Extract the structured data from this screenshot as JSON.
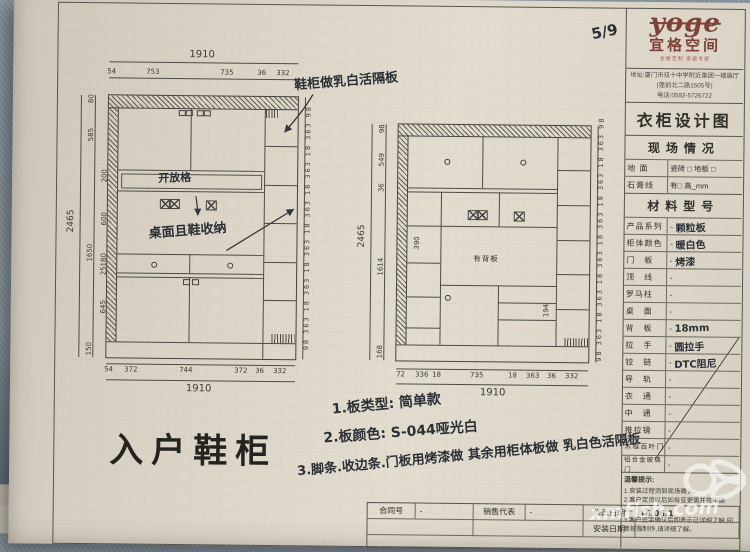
{
  "photo": {
    "page_number": "5/9",
    "watermark": "xmfish.com"
  },
  "brand": {
    "logo": "yoge",
    "name": "宜格空间",
    "tagline": "全屋定制 家居专家",
    "address1": "地址:厦门市双十中学附近集团一楼展厅",
    "address2": "(莲前北二路1505号)",
    "phone": "电话:0592-5726722"
  },
  "titleblock": {
    "sheet_title": "衣柜设计图",
    "site_title": "现场情况",
    "site_rows": [
      {
        "label": "地  面",
        "value": "瓷砖 □ 地板 □"
      },
      {
        "label": "石膏线",
        "value": "有□ 高_mm"
      }
    ],
    "material_title": "材料型号",
    "material_rows": [
      {
        "label": "产品系列",
        "dash": "-",
        "value": "颗粒板"
      },
      {
        "label": "柜体颜色",
        "dash": "-",
        "value": "暖白色"
      },
      {
        "label": "门　板",
        "dash": "-",
        "value": "烤漆"
      },
      {
        "label": "顶　线",
        "dash": "-",
        "value": ""
      },
      {
        "label": "罗马柱",
        "dash": "-",
        "value": ""
      },
      {
        "label": "桌　面",
        "dash": "-",
        "value": ""
      },
      {
        "label": "背　板",
        "dash": "-",
        "value": "18mm"
      },
      {
        "label": "拉　手",
        "dash": "-",
        "value": "圆拉手"
      },
      {
        "label": "铰　链",
        "dash": "-",
        "value": "DTC阻尼"
      },
      {
        "label": "导　轨",
        "dash": "-",
        "value": ""
      },
      {
        "label": "衣　通",
        "dash": "-",
        "value": ""
      },
      {
        "label": "中　通",
        "dash": "-",
        "value": ""
      },
      {
        "label": "推拉镜",
        "dash": "-",
        "value": ""
      },
      {
        "label": "木框百叶门",
        "dash": "-",
        "value": ""
      },
      {
        "label": "铝合金玻璃门",
        "dash": "-",
        "value": ""
      }
    ],
    "notes_title": "温馨提示:",
    "notes": [
      "1.安装过程须到现场确认。",
      "2.客户定货以后如有变更需并签字确认。",
      "3.客户签字确认后即表示已详细了解,同意按图制作,请详细了解。"
    ]
  },
  "footer": {
    "row1": [
      {
        "label": "合同号",
        "value": "-"
      },
      {
        "label": "销售代表",
        "value": "-"
      },
      {
        "label": "修改日期",
        "value": "16.06.1"
      }
    ],
    "row2": [
      {
        "label": "安装日期",
        "value": "-"
      }
    ]
  },
  "drawing": {
    "title": "入户鞋柜",
    "hand_top_note": "鞋柜做乳白活隔板",
    "hand_open_shelf": "开放格",
    "hand_desk": "桌面且鞋收纳",
    "back_panel": "有背板",
    "note1": "1.板类型: 简单款",
    "note2": "2.板颜色: S-044哑光白",
    "note3": "3.脚条.收边条.门板用烤漆做 其余用柜体板做 乳白色活隔板"
  },
  "left_cab": {
    "top_total": "1910",
    "top_dims": [
      "54",
      "753",
      "735",
      "36",
      "332"
    ],
    "left_total": "2465",
    "outer_v": [
      "80",
      "585",
      "1650",
      "150"
    ],
    "inner_v": [
      "200",
      "600",
      "180",
      "25",
      "645"
    ],
    "right_v": "98 363 18 363 18 363 18 363 18 363 18 363 98",
    "bottom_dims": [
      "54",
      "372",
      "744",
      "372",
      "36",
      "332"
    ],
    "bottom_total": "1910"
  },
  "right_cab": {
    "left_total": "2465",
    "left_v": [
      "98",
      "549",
      "36",
      "1614",
      "168"
    ],
    "dim_390": "390",
    "dim_194": "194",
    "right_v": "98 363 18 363 18 363 18 363 18 363 18 363 98",
    "bottom_dims": [
      "72",
      "336",
      "18",
      "735",
      "18",
      "363",
      "36",
      "332"
    ],
    "bottom_total": "1910"
  }
}
